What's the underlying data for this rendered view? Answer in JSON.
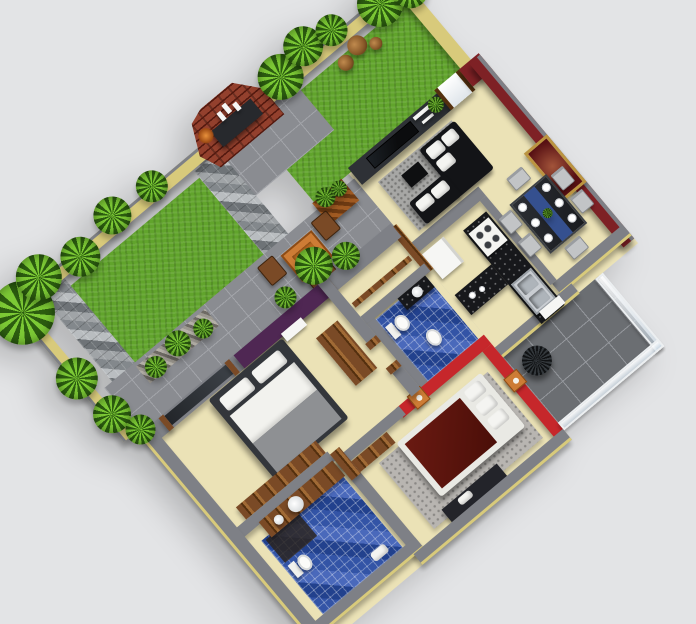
{
  "title": "3D isometric house floor plan render with garden",
  "palette": {
    "bg": "#e3e4e6",
    "wallCap": "#7e8086",
    "wallCapDark": "#5f6166",
    "wallFace": "#d8ca7b",
    "floorCream": "#ebe2b6",
    "grass": "#61a42c",
    "patio": "#8a8c91",
    "patioLine": "#a2a4a9",
    "cobbleA": "#b9bdc0",
    "cobbleB": "#83888c",
    "cobbleC": "#a0a4a7",
    "cobbleD": "#6e7377",
    "brick": "#93402d",
    "brickDark": "#54190f",
    "charcoal": "#2e3136",
    "tvBlack": "#0b0c0e",
    "maroon": "#7e2125",
    "maroonDark": "#571013",
    "redAccent": "#c6272b",
    "purple": "#4f2753",
    "blueTile": "#3354a6",
    "blueTileDark": "#22418d",
    "wood": "#7a4a26",
    "woodDark": "#54300f",
    "woodLight": "#a06a35",
    "orange": "#cd7c35",
    "rug": "#a7a7a5",
    "rugSpeckle": "#b8b5b1",
    "sofa": "#131417",
    "white": "#f6f6f4",
    "steel": "#c9cdd2",
    "gold": "#bb9440",
    "balconyTile": "#6b6e72",
    "balconyLine": "#94979c",
    "leafLight": "#7cc935",
    "leafDark": "#2c5d10",
    "potBrown": "#8a5a2a",
    "glass": "#dfe9f0"
  },
  "regions": [
    "garden-lawn",
    "brick-barbecue",
    "cobblestone-path",
    "outdoor-patio",
    "living-room",
    "dining-room",
    "kitchen",
    "hallway",
    "bathroom-2",
    "master-bedroom",
    "master-bathroom",
    "bedroom-2",
    "balcony"
  ],
  "visible_objects": {
    "clay_pots": 3,
    "dining_chairs": 6,
    "dining_plates": 6,
    "framed_painting": 1,
    "beds": 2,
    "toilets": 3,
    "sofas": 1,
    "outdoor_table_chairs": 3,
    "balcony_plant": 1
  }
}
